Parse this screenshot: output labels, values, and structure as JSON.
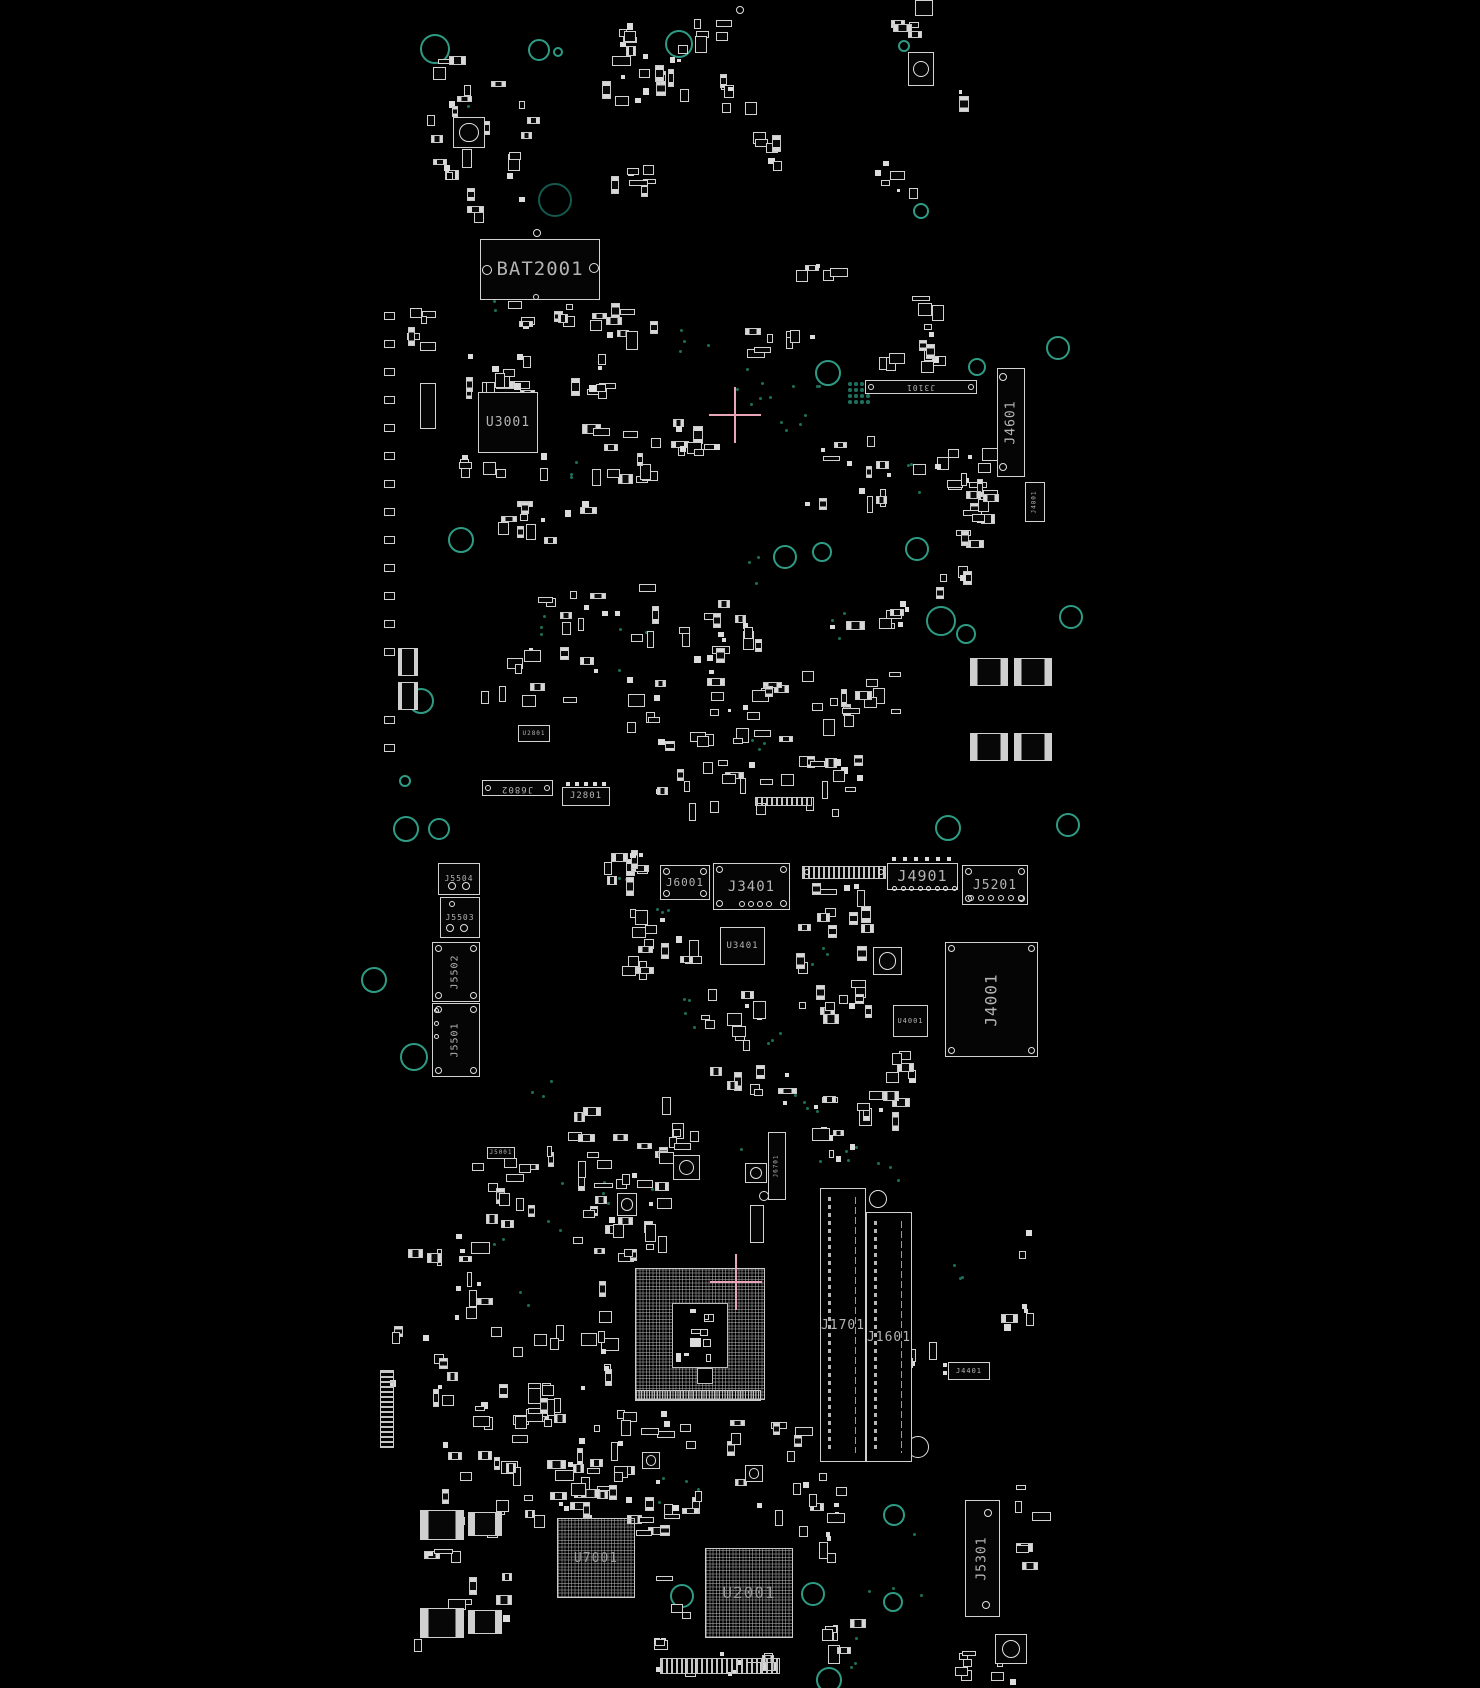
{
  "canvas": {
    "width": 1480,
    "height": 1688,
    "background": "#000000"
  },
  "colors": {
    "outline": "#d2d2d2",
    "pad": "#dcdcdc",
    "label": "#b4b4b4",
    "hole_ring": "#2e9c85",
    "via": "#1e6f5c",
    "crosshair": "#e9a6b8",
    "bga_grid": "#bebebe"
  },
  "components": [
    {
      "id": "bat2001",
      "label": "BAT2001",
      "type": "chip",
      "x": 480,
      "y": 239,
      "w": 120,
      "h": 61,
      "fs": 19,
      "rings": [
        [
          487,
          270,
          5
        ],
        [
          594,
          268,
          5
        ],
        [
          537,
          233,
          4
        ],
        [
          536,
          297,
          3
        ]
      ]
    },
    {
      "id": "u3001",
      "label": "U3001",
      "type": "chip",
      "x": 478,
      "y": 392,
      "w": 60,
      "h": 61,
      "fs": 13
    },
    {
      "id": "j3101",
      "label": "J3101",
      "type": "chip",
      "x": 865,
      "y": 380,
      "w": 112,
      "h": 14,
      "fs": 8,
      "rot": 180,
      "rings": [
        [
          871,
          387,
          3
        ],
        [
          971,
          387,
          3
        ]
      ]
    },
    {
      "id": "j4601",
      "label": "J4601",
      "type": "chip",
      "x": 997,
      "y": 368,
      "w": 28,
      "h": 109,
      "fs": 13,
      "rot": -90,
      "rings": [
        [
          1003,
          377,
          4
        ],
        [
          1003,
          467,
          4
        ]
      ]
    },
    {
      "id": "j4801",
      "label": "J4801",
      "type": "chip",
      "x": 1025,
      "y": 482,
      "w": 20,
      "h": 40,
      "fs": 6,
      "rot": -90
    },
    {
      "id": "j6802",
      "label": "J6802",
      "type": "chip",
      "x": 482,
      "y": 780,
      "w": 71,
      "h": 16,
      "fs": 9,
      "rot": 180,
      "rings": [
        [
          488,
          788,
          3
        ],
        [
          547,
          788,
          3
        ]
      ]
    },
    {
      "id": "j2801",
      "label": "J2801",
      "type": "chip",
      "x": 562,
      "y": 787,
      "w": 48,
      "h": 19,
      "fs": 9,
      "pins": [
        {
          "x": 566,
          "y": 782,
          "n": 5,
          "dx": 9,
          "dy": 0,
          "r": 2,
          "style": "sq"
        }
      ]
    },
    {
      "id": "u2801",
      "label": "U2801",
      "type": "chip",
      "x": 518,
      "y": 725,
      "w": 32,
      "h": 17,
      "fs": 6
    },
    {
      "id": "mic2001",
      "label": "",
      "type": "cam",
      "x": 908,
      "y": 52,
      "w": 26,
      "h": 34
    },
    {
      "id": "qfn-topleft",
      "label": "",
      "type": "cam",
      "x": 453,
      "y": 117,
      "w": 32,
      "h": 31
    },
    {
      "id": "u-left-u3001",
      "label": "",
      "type": "chip",
      "x": 420,
      "y": 383,
      "w": 16,
      "h": 46,
      "fs": 6
    },
    {
      "id": "soic-r1",
      "label": "",
      "type": "icpads",
      "x": 970,
      "y": 658,
      "w": 38,
      "h": 28
    },
    {
      "id": "soic-r2",
      "label": "",
      "type": "icpads",
      "x": 1014,
      "y": 658,
      "w": 38,
      "h": 28
    },
    {
      "id": "soic-r3",
      "label": "",
      "type": "icpads",
      "x": 970,
      "y": 733,
      "w": 38,
      "h": 28
    },
    {
      "id": "soic-r4",
      "label": "",
      "type": "icpads",
      "x": 1014,
      "y": 733,
      "w": 38,
      "h": 28
    },
    {
      "id": "soic-l1",
      "label": "",
      "type": "icpads",
      "x": 398,
      "y": 648,
      "w": 20,
      "h": 28
    },
    {
      "id": "soic-l2",
      "label": "",
      "type": "icpads",
      "x": 398,
      "y": 682,
      "w": 20,
      "h": 28
    },
    {
      "id": "conn-top-edge",
      "label": "",
      "type": "chip",
      "x": 915,
      "y": 0,
      "w": 18,
      "h": 16,
      "fs": 5
    },
    {
      "id": "j5504",
      "label": "J5504",
      "type": "chip",
      "x": 438,
      "y": 863,
      "w": 42,
      "h": 32,
      "fs": 8,
      "rings": [
        [
          452,
          886,
          4
        ],
        [
          466,
          886,
          4
        ]
      ]
    },
    {
      "id": "j5503",
      "label": "J5503",
      "type": "chip",
      "x": 440,
      "y": 897,
      "w": 40,
      "h": 41,
      "fs": 8,
      "rings": [
        [
          450,
          928,
          4
        ],
        [
          464,
          928,
          4
        ],
        [
          452,
          904,
          3
        ]
      ]
    },
    {
      "id": "j5502",
      "label": "J5502",
      "type": "chip",
      "x": 432,
      "y": 942,
      "w": 48,
      "h": 60,
      "fs": 10,
      "rot": -90,
      "corners": true
    },
    {
      "id": "j5501",
      "label": "J5501",
      "type": "chip",
      "x": 432,
      "y": 1003,
      "w": 48,
      "h": 74,
      "fs": 10,
      "rot": -90,
      "corners": true,
      "pins": [
        {
          "x": 434,
          "y": 1008,
          "n": 3,
          "dx": 0,
          "dy": 13,
          "r": 2.5,
          "style": "ring"
        }
      ]
    },
    {
      "id": "j6001",
      "label": "J6001",
      "type": "chip",
      "x": 660,
      "y": 865,
      "w": 50,
      "h": 35,
      "fs": 11,
      "corners": true
    },
    {
      "id": "j3401",
      "label": "J3401",
      "type": "chip",
      "x": 713,
      "y": 863,
      "w": 77,
      "h": 47,
      "fs": 14,
      "corners": true,
      "pins": [
        {
          "x": 739,
          "y": 901,
          "n": 4,
          "dx": 9,
          "dy": 0,
          "r": 3,
          "style": "ring"
        }
      ]
    },
    {
      "id": "conn-mid",
      "label": "",
      "type": "strip-h",
      "x": 802,
      "y": 866,
      "w": 84,
      "h": 13,
      "rings": [
        [
          807,
          872,
          3
        ],
        [
          881,
          872,
          3
        ]
      ]
    },
    {
      "id": "j4901",
      "label": "J4901",
      "type": "chip",
      "x": 887,
      "y": 863,
      "w": 71,
      "h": 27,
      "fs": 15,
      "pins": [
        {
          "x": 892,
          "y": 886,
          "n": 8,
          "dx": 8.5,
          "dy": 0,
          "r": 2.5,
          "style": "ring"
        },
        {
          "x": 892,
          "y": 857,
          "n": 6,
          "dx": 11,
          "dy": 0,
          "r": 2,
          "style": "sq"
        }
      ]
    },
    {
      "id": "j5201",
      "label": "J5201",
      "type": "chip",
      "x": 962,
      "y": 865,
      "w": 66,
      "h": 40,
      "fs": 13,
      "corners": true,
      "pins": [
        {
          "x": 968,
          "y": 895,
          "n": 6,
          "dx": 10,
          "dy": 0,
          "r": 3,
          "style": "ring"
        }
      ]
    },
    {
      "id": "u3401",
      "label": "U3401",
      "type": "chip",
      "x": 720,
      "y": 927,
      "w": 45,
      "h": 38,
      "fs": 9
    },
    {
      "id": "u4001",
      "label": "U4001",
      "type": "chip",
      "x": 893,
      "y": 1005,
      "w": 35,
      "h": 32,
      "fs": 7
    },
    {
      "id": "j4001",
      "label": "J4001",
      "type": "chip",
      "x": 945,
      "y": 942,
      "w": 93,
      "h": 115,
      "fs": 16,
      "rot": -90,
      "corners": true
    },
    {
      "id": "j6701",
      "label": "J6701",
      "type": "chip",
      "x": 768,
      "y": 1132,
      "w": 18,
      "h": 68,
      "fs": 6,
      "rot": -90
    },
    {
      "id": "j5001",
      "label": "J5001",
      "type": "chip",
      "x": 487,
      "y": 1147,
      "w": 28,
      "h": 12,
      "fs": 6
    },
    {
      "id": "u-cpu",
      "label": "",
      "type": "bga",
      "x": 635,
      "y": 1268,
      "w": 130,
      "h": 132,
      "fs": 0,
      "inner": [
        [
          672,
          1303,
          56,
          65,
          10
        ],
        [
          697,
          1368,
          16,
          16,
          0
        ]
      ]
    },
    {
      "id": "j1701",
      "label": "J1701",
      "type": "slot",
      "x": 820,
      "y": 1188,
      "w": 46,
      "h": 274,
      "fs": 13
    },
    {
      "id": "j1601",
      "label": "J1601",
      "type": "slot",
      "x": 866,
      "y": 1212,
      "w": 46,
      "h": 250,
      "fs": 13
    },
    {
      "id": "j4401",
      "label": "J4401",
      "type": "chip",
      "x": 948,
      "y": 1362,
      "w": 42,
      "h": 18,
      "fs": 7,
      "pins": [
        {
          "x": 943,
          "y": 1363,
          "n": 2,
          "dx": 0,
          "dy": 8,
          "r": 2,
          "style": "sq"
        }
      ]
    },
    {
      "id": "conn-fine",
      "label": "",
      "type": "strip-fine",
      "x": 635,
      "y": 1390,
      "w": 126,
      "h": 11
    },
    {
      "id": "u7001",
      "label": "U7001",
      "type": "bga",
      "x": 557,
      "y": 1518,
      "w": 78,
      "h": 80,
      "fs": 13
    },
    {
      "id": "u2001",
      "label": "U2001",
      "type": "bga",
      "x": 705,
      "y": 1548,
      "w": 88,
      "h": 90,
      "fs": 16
    },
    {
      "id": "j5301",
      "label": "J5301",
      "type": "chip",
      "x": 965,
      "y": 1500,
      "w": 35,
      "h": 117,
      "fs": 13,
      "rot": -90,
      "rings": [
        [
          988,
          1513,
          4
        ],
        [
          986,
          1605,
          4
        ]
      ]
    },
    {
      "id": "edge-strip-left",
      "label": "",
      "type": "strip-v",
      "x": 380,
      "y": 1370,
      "w": 14,
      "h": 78
    },
    {
      "id": "strip-j3401-top",
      "label": "",
      "type": "strip-h",
      "x": 755,
      "y": 797,
      "w": 57,
      "h": 9
    },
    {
      "id": "strip-bottom",
      "label": "",
      "type": "strip-h",
      "x": 660,
      "y": 1658,
      "w": 120,
      "h": 16
    },
    {
      "id": "ic-bl1",
      "label": "",
      "type": "icpads",
      "x": 420,
      "y": 1510,
      "w": 44,
      "h": 30
    },
    {
      "id": "ic-bl2",
      "label": "",
      "type": "icpads",
      "x": 468,
      "y": 1512,
      "w": 34,
      "h": 24
    },
    {
      "id": "ic-bl3",
      "label": "",
      "type": "icpads",
      "x": 420,
      "y": 1608,
      "w": 44,
      "h": 30
    },
    {
      "id": "ic-bl4",
      "label": "",
      "type": "icpads",
      "x": 468,
      "y": 1610,
      "w": 34,
      "h": 24
    },
    {
      "id": "btn-br",
      "label": "",
      "type": "cam",
      "x": 995,
      "y": 1634,
      "w": 32,
      "h": 30
    },
    {
      "id": "btn-1",
      "label": "",
      "type": "cam",
      "x": 873,
      "y": 947,
      "w": 29,
      "h": 28
    },
    {
      "id": "btn-2",
      "label": "",
      "type": "cam",
      "x": 745,
      "y": 1163,
      "w": 22,
      "h": 20
    },
    {
      "id": "btn-3",
      "label": "",
      "type": "cam",
      "x": 673,
      "y": 1155,
      "w": 27,
      "h": 25
    },
    {
      "id": "btn-4",
      "label": "",
      "type": "cam",
      "x": 617,
      "y": 1193,
      "w": 20,
      "h": 23
    },
    {
      "id": "btn-5",
      "label": "",
      "type": "cam",
      "x": 642,
      "y": 1452,
      "w": 18,
      "h": 17
    },
    {
      "id": "btn-6",
      "label": "",
      "type": "cam",
      "x": 745,
      "y": 1465,
      "w": 18,
      "h": 17
    },
    {
      "id": "part-mid",
      "label": "",
      "type": "chip",
      "x": 750,
      "y": 1205,
      "w": 14,
      "h": 38,
      "fs": 5
    }
  ],
  "clusters": [
    [
      425,
      55,
      115,
      150,
      24
    ],
    [
      600,
      20,
      60,
      90,
      14
    ],
    [
      653,
      38,
      40,
      62,
      8
    ],
    [
      690,
      18,
      40,
      40,
      5
    ],
    [
      716,
      60,
      48,
      55,
      7
    ],
    [
      745,
      128,
      42,
      45,
      6
    ],
    [
      885,
      3,
      50,
      40,
      5
    ],
    [
      955,
      88,
      20,
      16,
      2
    ],
    [
      448,
      206,
      40,
      16,
      3
    ],
    [
      600,
      160,
      60,
      45,
      7
    ],
    [
      870,
      155,
      55,
      45,
      6
    ],
    [
      790,
      247,
      55,
      35,
      5
    ],
    [
      455,
      348,
      112,
      50,
      16
    ],
    [
      568,
      352,
      60,
      45,
      8
    ],
    [
      590,
      300,
      90,
      40,
      10
    ],
    [
      740,
      328,
      85,
      32,
      8
    ],
    [
      865,
      348,
      85,
      26,
      8
    ],
    [
      795,
      430,
      105,
      80,
      14
    ],
    [
      895,
      440,
      100,
      75,
      12
    ],
    [
      950,
      440,
      58,
      125,
      14
    ],
    [
      580,
      420,
      85,
      70,
      12
    ],
    [
      665,
      415,
      75,
      62,
      10
    ],
    [
      495,
      495,
      108,
      62,
      12
    ],
    [
      455,
      452,
      110,
      25,
      8
    ],
    [
      515,
      580,
      150,
      62,
      14
    ],
    [
      645,
      600,
      132,
      66,
      16
    ],
    [
      830,
      600,
      88,
      46,
      10
    ],
    [
      475,
      645,
      132,
      66,
      12
    ],
    [
      625,
      665,
      172,
      88,
      28
    ],
    [
      795,
      665,
      112,
      66,
      14
    ],
    [
      645,
      755,
      132,
      60,
      14
    ],
    [
      775,
      755,
      112,
      70,
      14
    ],
    [
      398,
      300,
      46,
      56,
      6
    ],
    [
      505,
      300,
      85,
      42,
      8
    ],
    [
      935,
      555,
      40,
      50,
      5
    ],
    [
      905,
      290,
      40,
      70,
      7
    ],
    [
      600,
      845,
      55,
      55,
      7
    ],
    [
      610,
      905,
      55,
      90,
      10
    ],
    [
      660,
      905,
      45,
      60,
      6
    ],
    [
      695,
      975,
      80,
      80,
      12
    ],
    [
      785,
      868,
      95,
      70,
      12
    ],
    [
      795,
      945,
      90,
      80,
      14
    ],
    [
      882,
      1048,
      58,
      38,
      6
    ],
    [
      700,
      1062,
      100,
      38,
      8
    ],
    [
      645,
      1085,
      58,
      95,
      10
    ],
    [
      560,
      1105,
      90,
      100,
      16
    ],
    [
      470,
      1145,
      92,
      85,
      14
    ],
    [
      630,
      843,
      28,
      20,
      3
    ],
    [
      398,
      1216,
      97,
      108,
      14
    ],
    [
      388,
      1324,
      215,
      108,
      30
    ],
    [
      430,
      1432,
      172,
      97,
      22
    ],
    [
      398,
      1500,
      120,
      150,
      12
    ],
    [
      495,
      1395,
      140,
      120,
      18
    ],
    [
      640,
      1405,
      210,
      115,
      26
    ],
    [
      560,
      1430,
      80,
      80,
      10
    ],
    [
      625,
      1475,
      80,
      120,
      12
    ],
    [
      795,
      1480,
      45,
      100,
      8
    ],
    [
      640,
      1600,
      60,
      80,
      8
    ],
    [
      820,
      1600,
      45,
      60,
      6
    ],
    [
      700,
      1650,
      90,
      35,
      8
    ],
    [
      955,
      1650,
      70,
      38,
      8
    ],
    [
      1015,
      1470,
      30,
      100,
      6
    ],
    [
      765,
      1090,
      115,
      90,
      14
    ],
    [
      865,
      1085,
      45,
      50,
      6
    ],
    [
      1001,
      1200,
      38,
      140,
      7
    ],
    [
      565,
      1205,
      70,
      60,
      8
    ],
    [
      598,
      1278,
      20,
      100,
      8
    ],
    [
      615,
      1180,
      55,
      80,
      10
    ],
    [
      610,
      1420,
      28,
      60,
      4
    ],
    [
      905,
      1340,
      40,
      40,
      4
    ]
  ],
  "edge_pads": [
    [
      384,
      312,
      13,
      28,
      11,
      8
    ],
    [
      384,
      716,
      2,
      28,
      11,
      8
    ]
  ],
  "holes": [
    [
      435,
      49,
      15
    ],
    [
      539,
      50,
      11
    ],
    [
      558,
      52,
      5
    ],
    [
      679,
      44,
      14
    ],
    [
      904,
      46,
      6
    ],
    [
      555,
      200,
      17,
      "#15584d"
    ],
    [
      921,
      211,
      8
    ],
    [
      828,
      373,
      13
    ],
    [
      1058,
      348,
      12
    ],
    [
      977,
      367,
      9
    ],
    [
      461,
      540,
      13
    ],
    [
      785,
      557,
      12
    ],
    [
      822,
      552,
      10
    ],
    [
      917,
      549,
      12
    ],
    [
      941,
      621,
      15
    ],
    [
      966,
      634,
      10
    ],
    [
      1071,
      617,
      12
    ],
    [
      421,
      701,
      13
    ],
    [
      405,
      781,
      6
    ],
    [
      406,
      829,
      13
    ],
    [
      439,
      829,
      11
    ],
    [
      948,
      828,
      13
    ],
    [
      1068,
      825,
      12
    ],
    [
      374,
      980,
      13
    ],
    [
      414,
      1057,
      14
    ],
    [
      682,
      1596,
      12
    ],
    [
      813,
      1594,
      12
    ],
    [
      894,
      1515,
      11
    ],
    [
      893,
      1602,
      10
    ],
    [
      829,
      1680,
      13
    ]
  ],
  "white_circles": [
    [
      740,
      10,
      4
    ],
    [
      878,
      1199,
      9
    ],
    [
      918,
      1447,
      11
    ],
    [
      832,
      1455,
      4
    ],
    [
      882,
      1453,
      4
    ],
    [
      905,
      1218,
      6
    ],
    [
      764,
      1196,
      5
    ]
  ],
  "vias": [
    [
      793,
      408,
      8,
      28
    ],
    [
      700,
      332,
      4,
      22
    ],
    [
      760,
      565,
      3,
      18
    ],
    [
      624,
      652,
      4,
      26
    ],
    [
      843,
      622,
      3,
      16
    ],
    [
      470,
      95,
      3,
      10
    ],
    [
      484,
      300,
      3,
      12
    ],
    [
      563,
      462,
      3,
      15
    ],
    [
      920,
      472,
      4,
      20
    ],
    [
      543,
      627,
      3,
      12
    ],
    [
      762,
      742,
      3,
      14
    ],
    [
      663,
      906,
      3,
      8
    ],
    [
      695,
      1012,
      4,
      16
    ],
    [
      770,
      1036,
      3,
      10
    ],
    [
      820,
      952,
      3,
      12
    ],
    [
      600,
      1190,
      8,
      60
    ],
    [
      670,
      1490,
      5,
      30
    ],
    [
      900,
      1560,
      4,
      40
    ],
    [
      850,
      1642,
      4,
      36
    ],
    [
      955,
      1268,
      3,
      10
    ],
    [
      757,
      1160,
      4,
      20
    ],
    [
      838,
      1162,
      4,
      25
    ],
    [
      500,
      1245,
      2,
      8
    ],
    [
      520,
      1295,
      2,
      10
    ],
    [
      545,
      1085,
      3,
      14
    ],
    [
      617,
      870,
      3,
      10
    ],
    [
      737,
      378,
      5,
      26
    ],
    [
      805,
      1105,
      4,
      18
    ],
    [
      890,
      1175,
      3,
      14
    ],
    [
      760,
      880,
      3,
      12
    ]
  ],
  "via_grids": [
    [
      848,
      382,
      4,
      4,
      6
    ]
  ],
  "crosshairs": [
    [
      735,
      415
    ],
    [
      736,
      1282
    ]
  ]
}
